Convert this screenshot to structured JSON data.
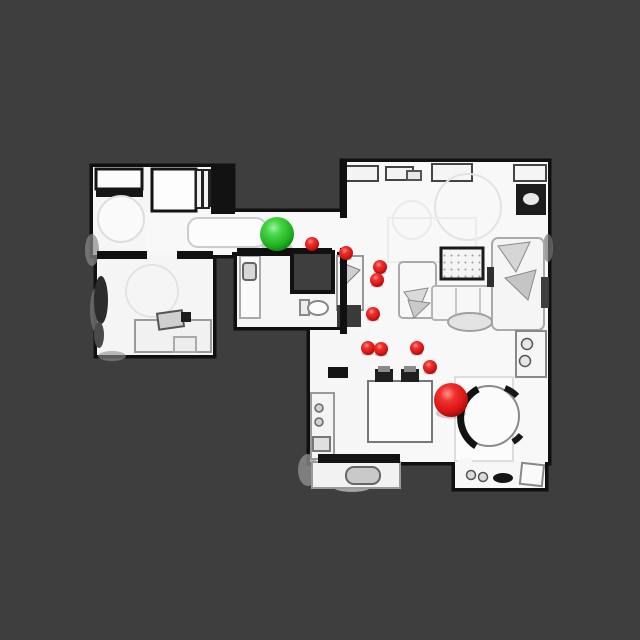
{
  "scene": {
    "description": "top-down-3d-scan-floorplan",
    "background_color": "#3e3e3e",
    "floor_color": "#f7f7f7",
    "wall_color": "#101010"
  },
  "markers": {
    "start": {
      "label": "start-marker",
      "color_hex": "#2ecc2e",
      "x": 277,
      "y": 234,
      "radius": 17
    },
    "goal": {
      "label": "goal-marker",
      "color_hex": "#dd1212",
      "x": 451,
      "y": 400,
      "radius": 17
    },
    "waypoints": {
      "label": "waypoint-marker",
      "color_hex": "#dd1212",
      "radius": 7,
      "points": [
        [
          312,
          244
        ],
        [
          346,
          253
        ],
        [
          380,
          267
        ],
        [
          377,
          280
        ],
        [
          373,
          314
        ],
        [
          368,
          348
        ],
        [
          381,
          349
        ],
        [
          417,
          348
        ],
        [
          430,
          367
        ]
      ]
    }
  }
}
